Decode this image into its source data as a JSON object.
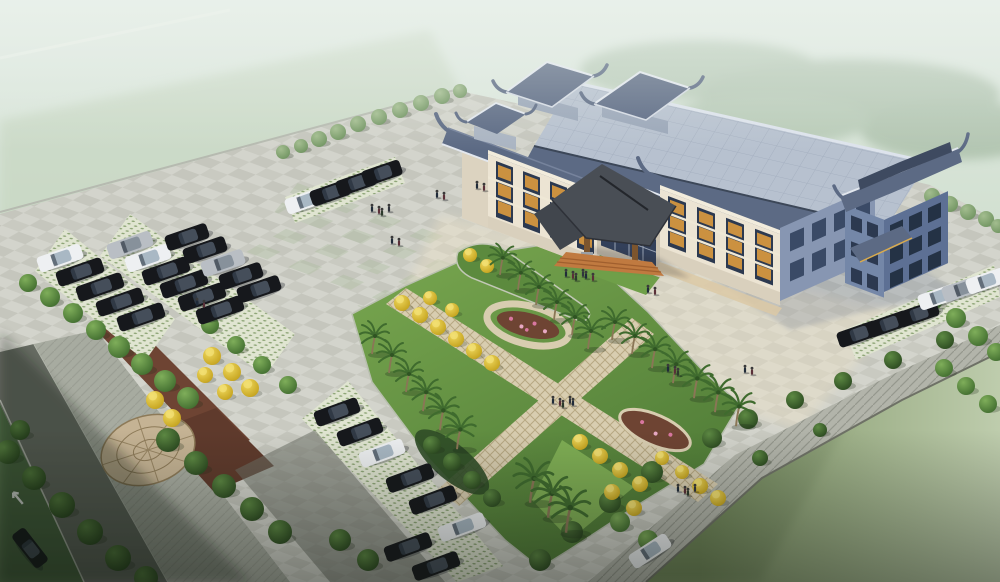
{
  "scene_meta": {
    "description": "Aerial architectural rendering of a traditional Chinese-style 4-storey office building with blue tiled hip-gable roofs and rooftop pavilions, fronted by a large checkerboard stone plaza, an X-shaped landscaped garden with palm and golden trees, grass-paver parking lots filled with dark sedans, a perimeter road with a white turn arrow, a circular cobblestone medallion, and lawns fading into mist."
  },
  "palette": {
    "mist_top": "#e0e9e2",
    "mist_mid": "#cddcca",
    "grass_haze": "#c3d3bc",
    "forest": "#7c9a78",
    "plaza": "#cbccc4",
    "checker_light": "#d9dad2",
    "checker_dark": "#bfc0b6",
    "green_tile": "#a9bb9a",
    "plaza_warm": "#efe3c8",
    "curb": "#b6bab0",
    "road": "#666b62",
    "sidewalk": "#a7aba0",
    "aisle": "#6e7168",
    "arrow_white": "#e9ece7",
    "grass_paver": "#e0e5d1",
    "paver_dot": "#8fa678",
    "lawn": "#7f9566",
    "lawn_mist": "#d4e0c6",
    "slope": "#b2b4aa",
    "mulch": "#6e4433",
    "mulch_dark": "#5f3a2c",
    "flower_pink": "#d877a0",
    "garden_light": "#79a74f",
    "garden_dark": "#4e7a36",
    "lawn_patch": "#6f9f49",
    "path_tan": "#d8cdb0",
    "path_line": "#b7a883",
    "mosaic_base": "#c5b394",
    "mosaic_line": "#8d7a58",
    "tree_green": "#4f7f39",
    "tree_dark": "#33522a",
    "tree_pale": "#84a171",
    "tree_yellow": "#e3c832",
    "palm_frond": "#3f6b2e",
    "palm_trunk": "#8a7656",
    "wall_cream": "#ece4d3",
    "wall_shade": "#dcd3c0",
    "wall_recess": "#cdc4b2",
    "wall_blue": "#7487a8",
    "wall_blue_dark": "#5d7094",
    "wing_blue": "#8796b2",
    "window_dark": "#2c3950",
    "window_navy": "#243245",
    "lattice_orange": "#cb9140",
    "roof_flat": "#b7c1cf",
    "roof_slate": "#5c6a84",
    "roof_dark": "#3e4a60",
    "roof_ridge": "#e2e7ee",
    "canopy_roof": "#494e55",
    "canopy_dark": "#41464d",
    "timber": "#7c552e",
    "steps_orange": "#c07a40",
    "steps_band": "#dcc9a6",
    "car_black": "#16181c",
    "car_white": "#eef0f2",
    "car_silver": "#b9bec4",
    "shadow_blue": "#46597f",
    "shadow_ground": "#1e2a18"
  },
  "inventory": {
    "building": {
      "style": "traditional Chinese hip-and-gable blue tile roofs on modern stone block",
      "storeys_visible": 4,
      "rooftop_pavilions": 2,
      "corner_tower": 1,
      "gate_tower": 1,
      "entrance_canopy": "timber porte-cochere with dark tiled roof and orange steps",
      "window_screens": "orange timber lattice panels"
    },
    "site": {
      "plaza_paving": "checkerboard granite with green accent tiles",
      "parking_surface": "grass-grid permeable pavers",
      "parking_areas": 3,
      "road_marking": "white turn arrow",
      "medallion": "circular cobblestone mosaic",
      "garden": "X-shaped paths with flower beds, palms and golden trees"
    },
    "counts": {
      "cars": 36,
      "round_trees": 66,
      "yellow_trees": 27,
      "palm_trees": 22,
      "people": 34
    }
  },
  "scene": {
    "trees": [
      [
        283,
        152,
        7,
        2
      ],
      [
        301,
        146,
        7,
        2
      ],
      [
        319,
        139,
        8,
        2
      ],
      [
        338,
        132,
        8,
        2
      ],
      [
        358,
        124,
        8,
        2
      ],
      [
        379,
        117,
        8,
        2
      ],
      [
        400,
        110,
        8,
        2
      ],
      [
        421,
        103,
        8,
        2
      ],
      [
        442,
        96,
        8,
        2
      ],
      [
        460,
        91,
        7,
        2
      ],
      [
        932,
        196,
        8,
        2
      ],
      [
        950,
        204,
        8,
        2
      ],
      [
        968,
        212,
        8,
        2
      ],
      [
        986,
        219,
        8,
        2
      ],
      [
        998,
        226,
        7,
        2
      ],
      [
        28,
        283,
        9,
        0
      ],
      [
        50,
        297,
        10,
        0
      ],
      [
        73,
        313,
        10,
        0
      ],
      [
        96,
        330,
        10,
        0
      ],
      [
        119,
        347,
        11,
        0
      ],
      [
        142,
        364,
        11,
        0
      ],
      [
        165,
        381,
        11,
        0
      ],
      [
        188,
        398,
        11,
        0
      ],
      [
        210,
        325,
        9,
        0
      ],
      [
        236,
        345,
        9,
        0
      ],
      [
        262,
        365,
        9,
        0
      ],
      [
        288,
        385,
        9,
        0
      ],
      [
        8,
        452,
        12,
        1
      ],
      [
        34,
        478,
        12,
        1
      ],
      [
        62,
        505,
        13,
        1
      ],
      [
        90,
        532,
        13,
        1
      ],
      [
        118,
        558,
        13,
        1
      ],
      [
        146,
        578,
        12,
        1
      ],
      [
        20,
        430,
        10,
        1
      ],
      [
        168,
        440,
        12,
        1
      ],
      [
        196,
        463,
        12,
        1
      ],
      [
        224,
        486,
        12,
        1
      ],
      [
        252,
        509,
        12,
        1
      ],
      [
        280,
        532,
        12,
        1
      ],
      [
        340,
        540,
        11,
        1
      ],
      [
        368,
        560,
        11,
        1
      ],
      [
        933,
        300,
        10,
        0
      ],
      [
        956,
        318,
        10,
        0
      ],
      [
        978,
        336,
        10,
        0
      ],
      [
        996,
        352,
        9,
        0
      ],
      [
        944,
        368,
        9,
        0
      ],
      [
        966,
        386,
        9,
        0
      ],
      [
        988,
        404,
        9,
        0
      ],
      [
        712,
        438,
        10,
        1
      ],
      [
        748,
        419,
        10,
        1
      ],
      [
        795,
        400,
        9,
        1
      ],
      [
        843,
        381,
        9,
        1
      ],
      [
        893,
        360,
        9,
        1
      ],
      [
        945,
        340,
        9,
        1
      ],
      [
        652,
        472,
        11,
        1
      ],
      [
        610,
        502,
        11,
        1
      ],
      [
        572,
        532,
        11,
        1
      ],
      [
        540,
        560,
        11,
        1
      ],
      [
        760,
        458,
        8,
        1
      ],
      [
        820,
        430,
        7,
        1
      ],
      [
        432,
        445,
        9,
        1
      ],
      [
        452,
        462,
        9,
        1
      ],
      [
        472,
        480,
        9,
        1
      ],
      [
        492,
        498,
        9,
        1
      ],
      [
        620,
        522,
        10,
        0
      ],
      [
        648,
        540,
        10,
        0
      ]
    ],
    "yellow_trees": [
      [
        212,
        356,
        9
      ],
      [
        232,
        372,
        9
      ],
      [
        250,
        388,
        9
      ],
      [
        225,
        392,
        8
      ],
      [
        205,
        375,
        8
      ],
      [
        155,
        400,
        9
      ],
      [
        172,
        418,
        9
      ],
      [
        402,
        303,
        8
      ],
      [
        420,
        315,
        8
      ],
      [
        438,
        327,
        8
      ],
      [
        456,
        339,
        8
      ],
      [
        474,
        351,
        8
      ],
      [
        492,
        363,
        8
      ],
      [
        430,
        298,
        7
      ],
      [
        452,
        310,
        7
      ],
      [
        580,
        442,
        8
      ],
      [
        600,
        456,
        8
      ],
      [
        620,
        470,
        8
      ],
      [
        640,
        484,
        8
      ],
      [
        662,
        458,
        7
      ],
      [
        682,
        472,
        7
      ],
      [
        700,
        486,
        8
      ],
      [
        718,
        498,
        8
      ],
      [
        612,
        492,
        8
      ],
      [
        634,
        508,
        8
      ],
      [
        470,
        255,
        7
      ],
      [
        487,
        266,
        7
      ]
    ],
    "palms": [
      [
        372,
        352,
        1
      ],
      [
        389,
        371,
        1
      ],
      [
        406,
        390,
        1
      ],
      [
        423,
        409,
        1.05
      ],
      [
        440,
        428,
        1.1
      ],
      [
        457,
        447,
        1.1
      ],
      [
        500,
        273,
        0.95
      ],
      [
        518,
        288,
        0.95
      ],
      [
        536,
        303,
        1
      ],
      [
        554,
        318,
        1
      ],
      [
        572,
        333,
        1
      ],
      [
        588,
        347,
        1
      ],
      [
        612,
        338,
        1
      ],
      [
        632,
        352,
        1
      ],
      [
        652,
        366,
        1.05
      ],
      [
        673,
        381,
        1.05
      ],
      [
        694,
        396,
        1.1
      ],
      [
        715,
        410,
        1.1
      ],
      [
        736,
        424,
        1.1
      ],
      [
        530,
        500,
        1.35
      ],
      [
        548,
        515,
        1.35
      ],
      [
        566,
        530,
        1.4
      ]
    ],
    "cars": [
      [
        60,
        258,
        -19,
        "white",
        46
      ],
      [
        80,
        272,
        -19,
        "black",
        48
      ],
      [
        100,
        287,
        -19,
        "black",
        48
      ],
      [
        120,
        302,
        -19,
        "black",
        48
      ],
      [
        141,
        317,
        -19,
        "black",
        48
      ],
      [
        130,
        245,
        -19,
        "silver",
        46
      ],
      [
        148,
        258,
        -19,
        "white",
        46
      ],
      [
        166,
        271,
        -19,
        "black",
        48
      ],
      [
        184,
        284,
        -19,
        "black",
        48
      ],
      [
        202,
        297,
        -19,
        "black",
        48
      ],
      [
        220,
        310,
        -19,
        "black",
        48
      ],
      [
        187,
        237,
        -19,
        "black",
        44
      ],
      [
        205,
        250,
        -19,
        "black",
        44
      ],
      [
        223,
        263,
        -19,
        "silver",
        44
      ],
      [
        241,
        276,
        -19,
        "black",
        44
      ],
      [
        259,
        289,
        -19,
        "black",
        44
      ],
      [
        305,
        201,
        -19,
        "white",
        40
      ],
      [
        330,
        193,
        -19,
        "black",
        40
      ],
      [
        356,
        183,
        -19,
        "black",
        40
      ],
      [
        382,
        173,
        -19,
        "black",
        40
      ],
      [
        337,
        412,
        -20,
        "black",
        46
      ],
      [
        360,
        432,
        -20,
        "black",
        46
      ],
      [
        382,
        453,
        -20,
        "white",
        46
      ],
      [
        410,
        478,
        -20,
        "black",
        48
      ],
      [
        433,
        500,
        -20,
        "black",
        48
      ],
      [
        462,
        527,
        -20,
        "white",
        48
      ],
      [
        408,
        547,
        -20,
        "black",
        48
      ],
      [
        436,
        566,
        -20,
        "black",
        48
      ],
      [
        858,
        334,
        -19,
        "black",
        42
      ],
      [
        888,
        324,
        -19,
        "black",
        42
      ],
      [
        918,
        314,
        -19,
        "black",
        42
      ],
      [
        938,
        297,
        -19,
        "white",
        40
      ],
      [
        962,
        289,
        -19,
        "silver",
        40
      ],
      [
        986,
        281,
        -19,
        "white",
        40
      ],
      [
        30,
        548,
        52,
        "black",
        42
      ],
      [
        650,
        551,
        -33,
        "white",
        44
      ]
    ],
    "people": [
      [
        372,
        211,
        4
      ],
      [
        437,
        197,
        2
      ],
      [
        477,
        188,
        2
      ],
      [
        392,
        243,
        2
      ],
      [
        566,
        276,
        6
      ],
      [
        648,
        292,
        2
      ],
      [
        668,
        371,
        3
      ],
      [
        745,
        372,
        2
      ],
      [
        553,
        403,
        5
      ],
      [
        678,
        491,
        4
      ],
      [
        197,
        305,
        2
      ]
    ]
  }
}
